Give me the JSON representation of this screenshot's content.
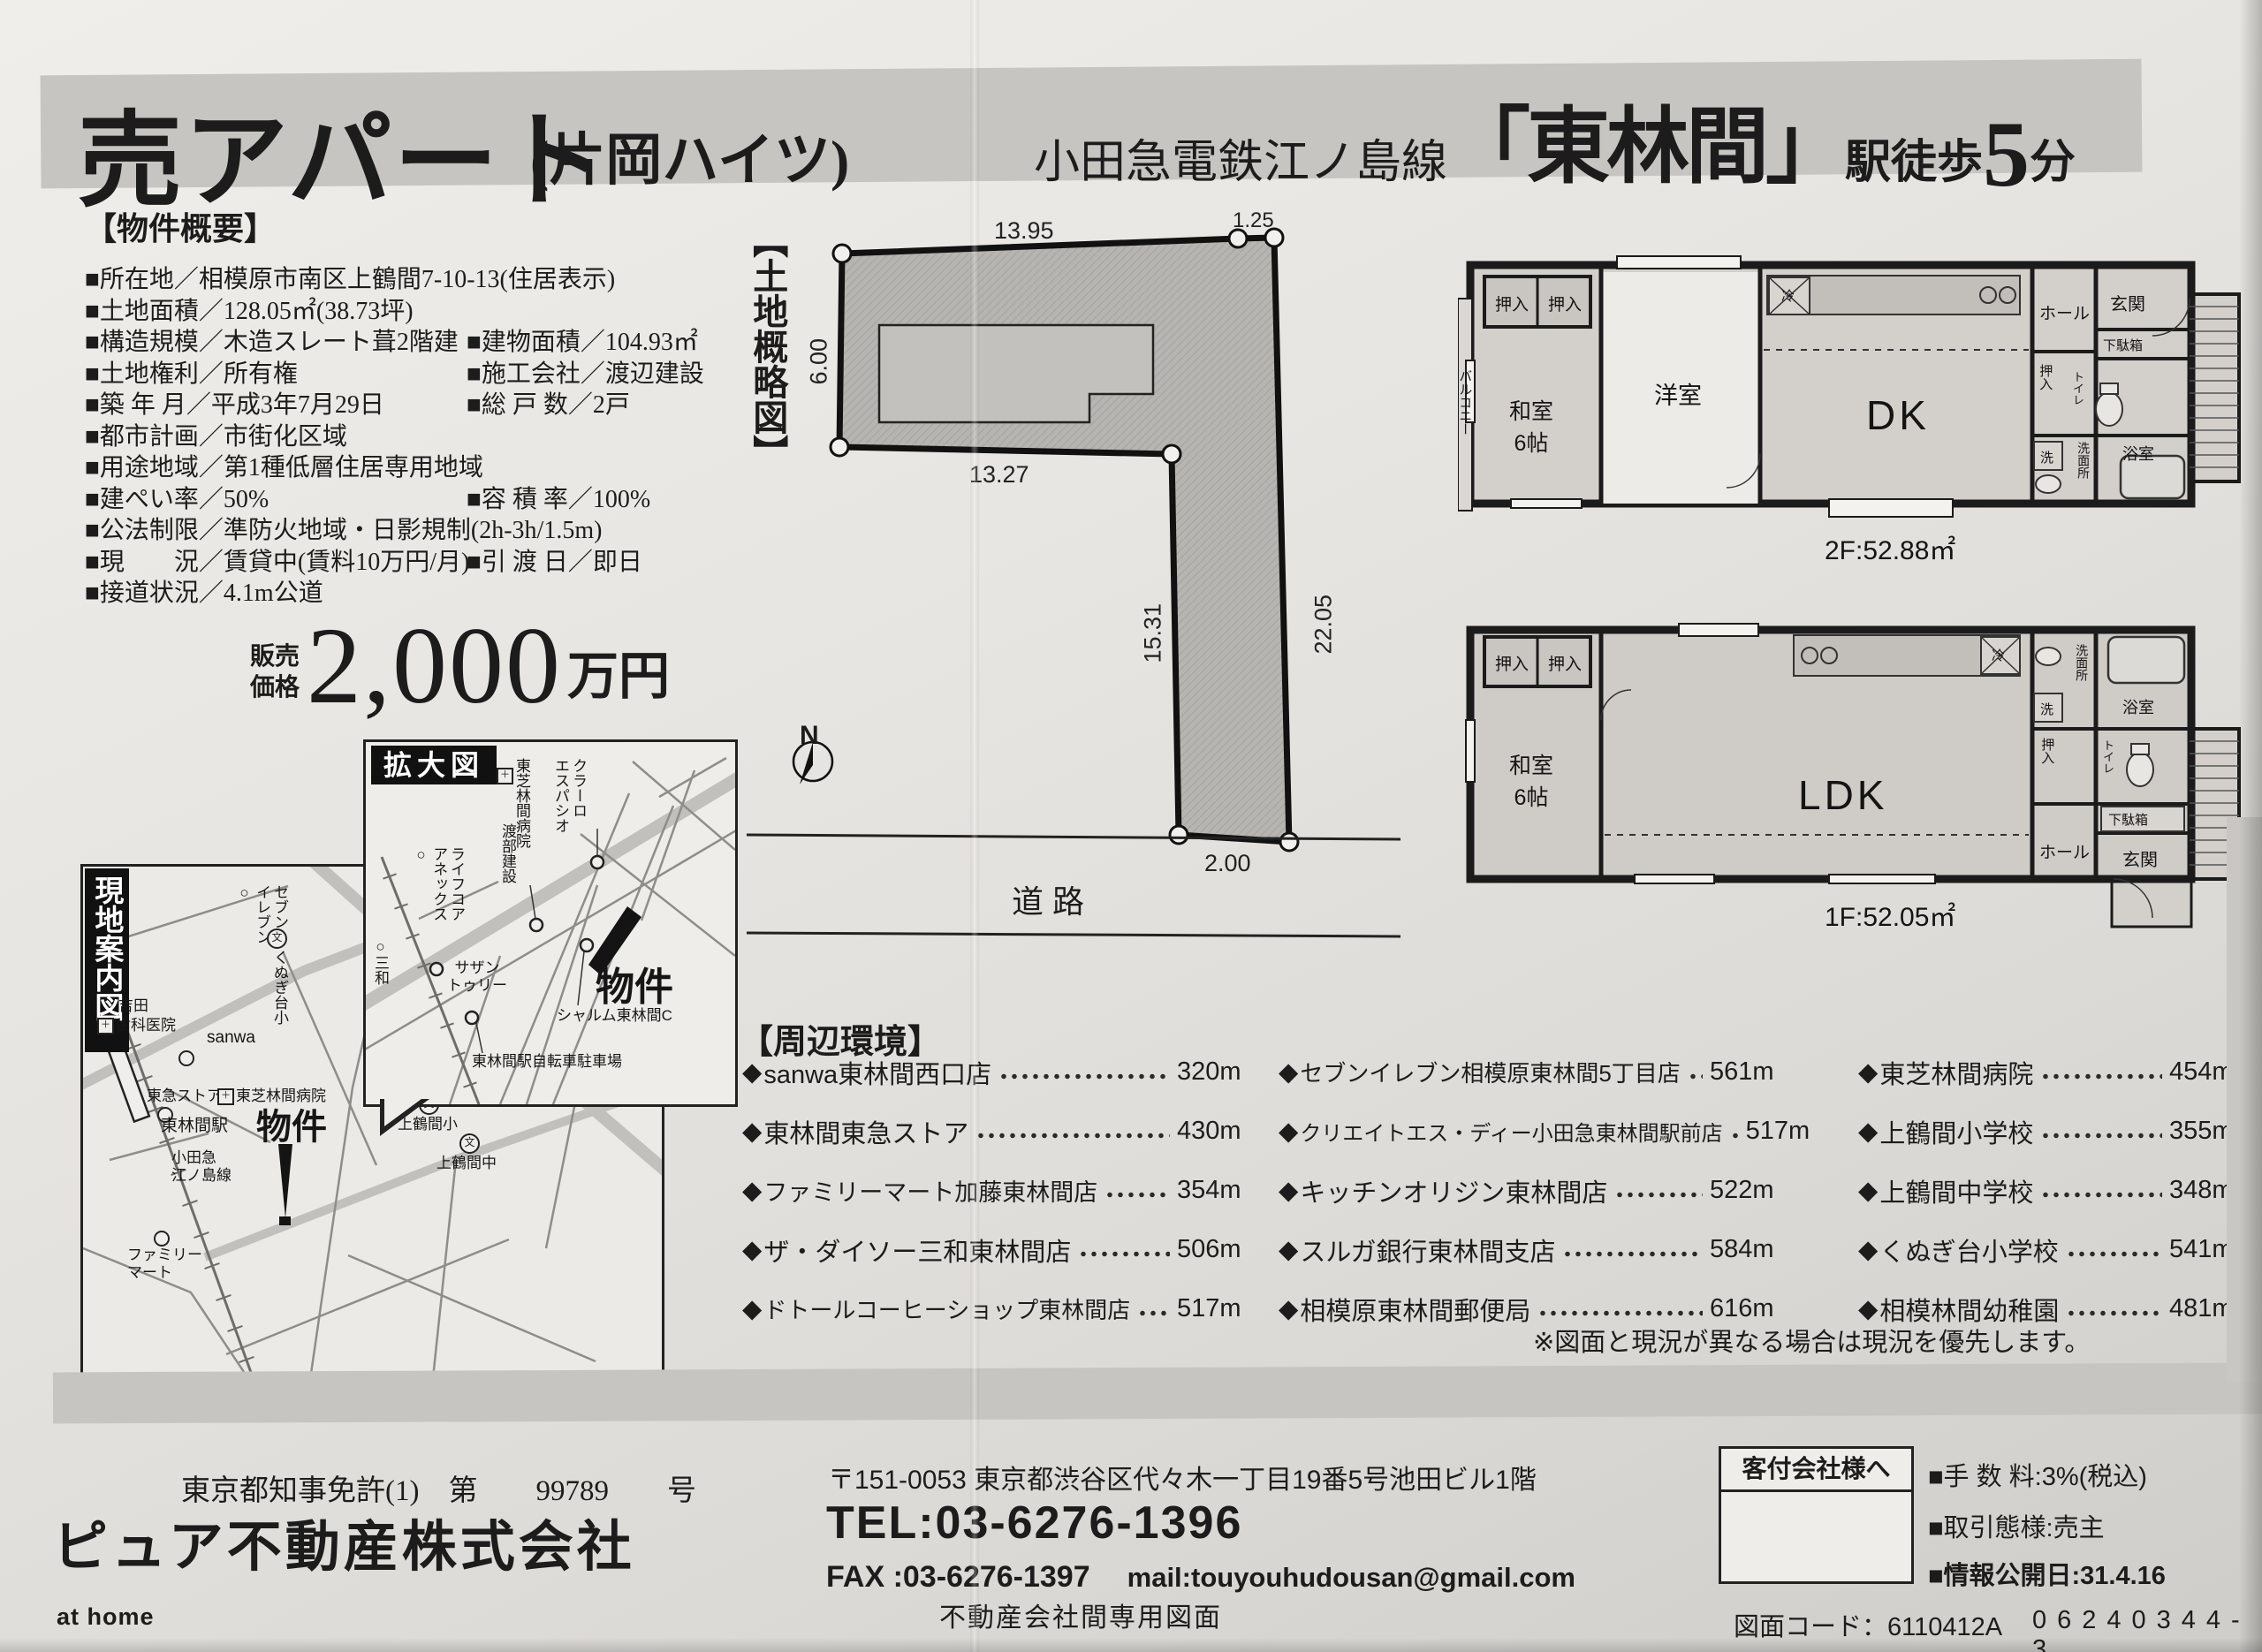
{
  "icons": {
    "diamond": "◆",
    "circle": "○",
    "school_mark": "文",
    "clinic_mark": "＋"
  },
  "header": {
    "title": "売アパート",
    "title_suffix": "(片岡ハイツ)",
    "line_prefix": "小田急電鉄江ノ島線",
    "station": "「東林間」",
    "walk_pre": "駅徒歩",
    "walk_min": "5",
    "walk_suf": "分"
  },
  "overview": {
    "heading": "【物件概要】",
    "rows": [
      {
        "left": "■所在地／相模原市南区上鶴間7-10-13(住居表示)"
      },
      {
        "left": "■土地面積／128.05㎡(38.73坪)"
      },
      {
        "left": "■構造規模／木造スレート葺2階建",
        "right": "■建物面積／104.93㎡"
      },
      {
        "left": "■土地権利／所有権",
        "right": "■施工会社／渡辺建設"
      },
      {
        "left": "■築 年 月／平成3年7月29日",
        "right": "■総 戸 数／2戸"
      },
      {
        "left": "■都市計画／市街化区域"
      },
      {
        "left": "■用途地域／第1種低層住居専用地域"
      },
      {
        "left": "■建ぺい率／50%",
        "right": "■容 積 率／100%"
      },
      {
        "left": "■公法制限／準防火地域・日影規制(2h-3h/1.5m)"
      },
      {
        "left": "■現　　況／賃貸中(賃料10万円/月)",
        "right": "■引 渡 日／即日"
      },
      {
        "left": "■接道状況／4.1m公道"
      }
    ]
  },
  "price": {
    "label": "販売\n価格",
    "amount": "2,000",
    "unit": "万円"
  },
  "land": {
    "heading": "【土地概略図】",
    "dim_top": "13.95",
    "dim_top_right": "1.25",
    "dim_left": "6.00",
    "dim_bottom_left": "13.27",
    "dim_inner": "15.31",
    "dim_right": "22.05",
    "dim_bottom": "2.00",
    "road": "道路",
    "north": "N"
  },
  "plan2f": {
    "balcony": "バルコニー",
    "closet_a": "押入",
    "closet_b": "押入",
    "washitsu": "和室\n6帖",
    "yoshitsu": "洋室",
    "dk": "DK",
    "fridge": "冷",
    "hall": "ホール",
    "entrance": "玄関",
    "shoe_box": "下駄箱",
    "closet_c": "押入",
    "toilet": "トイレ",
    "washer": "洗",
    "washroom": "洗面所",
    "bath": "浴室",
    "area": "2F:52.88㎡"
  },
  "plan1f": {
    "closet_a": "押入",
    "closet_b": "押入",
    "washitsu": "和室\n6帖",
    "ldk": "LDK",
    "fridge": "冷",
    "washroom": "洗面所",
    "washer": "洗",
    "closet_c": "押入",
    "hall": "ホール",
    "bath": "浴室",
    "toilet": "トイレ",
    "shoe_box": "下駄箱",
    "entrance": "玄関",
    "area": "1F:52.05㎡"
  },
  "maps": {
    "enlarged": {
      "title": "拡大図",
      "hospital": "東芝林間病院",
      "claro": "クラーロ\nエスパシオ",
      "watanabe": "渡部建設",
      "lifecore": "ライフコア\nアネックス○",
      "sanwa": "○三和",
      "southern": "サザン\nトゥリー",
      "bukken": "物件",
      "charme": "シャルム東林間C",
      "parking": "東林間駅自転車駐車場"
    },
    "guide": {
      "title": "現地案内図",
      "seven": "セブン\nイレブン○",
      "kunugi": "くぬぎ台小",
      "yoshida": "吉田",
      "yoshida2": "歯科医院",
      "sanwa": "sanwa",
      "tokyu": "東急ストア",
      "toshiba": "東芝林間病院",
      "station": "東林間駅",
      "odakyu": "小田急\n江ノ島線",
      "bukken": "物件",
      "kami_sho": "上鶴間小",
      "kami_chu": "上鶴間中",
      "family": "ファミリー\nマート"
    }
  },
  "surroundings": {
    "heading": "【周辺環境】",
    "col1": [
      {
        "name": "sanwa東林間西口店",
        "dist": "320m"
      },
      {
        "name": "東林間東急ストア",
        "dist": "430m"
      },
      {
        "name": "ファミリーマート加藤東林間店",
        "dist": "354m"
      },
      {
        "name": "ザ・ダイソー三和東林間店",
        "dist": "506m"
      },
      {
        "name": "ドトールコーヒーショップ東林間店",
        "dist": "517m"
      }
    ],
    "col2": [
      {
        "name": "セブンイレブン相模原東林間5丁目店",
        "dist": "561m"
      },
      {
        "name": "クリエイトエス・ディー小田急東林間駅前店",
        "dist": "517m"
      },
      {
        "name": "キッチンオリジン東林間店",
        "dist": "522m"
      },
      {
        "name": "スルガ銀行東林間支店",
        "dist": "584m"
      },
      {
        "name": "相模原東林間郵便局",
        "dist": "616m"
      }
    ],
    "col3": [
      {
        "name": "東芝林間病院",
        "dist": "454m"
      },
      {
        "name": "上鶴間小学校",
        "dist": "355m"
      },
      {
        "name": "上鶴間中学校",
        "dist": "348m"
      },
      {
        "name": "くぬぎ台小学校",
        "dist": "541m"
      },
      {
        "name": "相模林間幼稚園",
        "dist": "481m"
      }
    ],
    "note": "※図面と現況が異なる場合は現況を優先します。"
  },
  "footer": {
    "license": "東京都知事免許(1)　第　　99789　　号",
    "company": "ピュア不動産株式会社",
    "athome": "at home",
    "address": "〒151-0053 東京都渋谷区代々木一丁目19番5号池田ビル1階",
    "tel": "TEL:03-6276-1396",
    "fax": "FAX :03-6276-1397",
    "mail": "mail:touyouhudousan@gmail.com",
    "doc_type": "不動産会社間専用図面",
    "agent_box_title": "客付会社様へ",
    "fee": "■手 数 料:3%(税込)",
    "transaction": "■取引態様:売主",
    "info_date": "■情報公開日:31.4.16",
    "drawing_code": "図面コード：6110412A",
    "serial": "06240344-3"
  }
}
